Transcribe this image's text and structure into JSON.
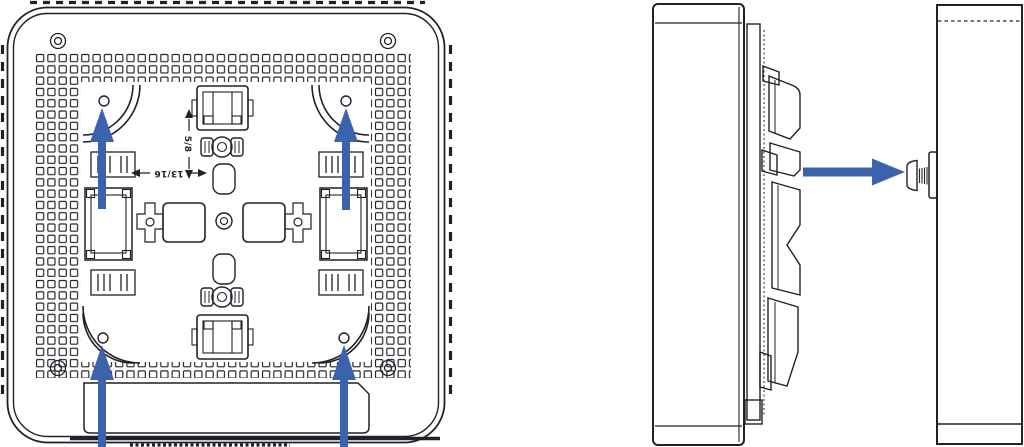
{
  "colors": {
    "line": "#232029",
    "arrow": "#3b63ad",
    "background": "#ffffff"
  },
  "labels": {
    "dim_horizontal": "13/16",
    "dim_vertical": "5/8"
  },
  "parts": {
    "back_view": "mounting-plate-back-view",
    "side_view": "device-side-view",
    "wall": "wall-cross-section",
    "screw": "wall-mount-screw",
    "mount_arrow_targets": [
      "mounting-hole-top-left",
      "mounting-hole-top-right",
      "mounting-hole-bottom-left",
      "mounting-hole-bottom-right"
    ],
    "screw_arrow_target": "wall-mount-screw"
  }
}
